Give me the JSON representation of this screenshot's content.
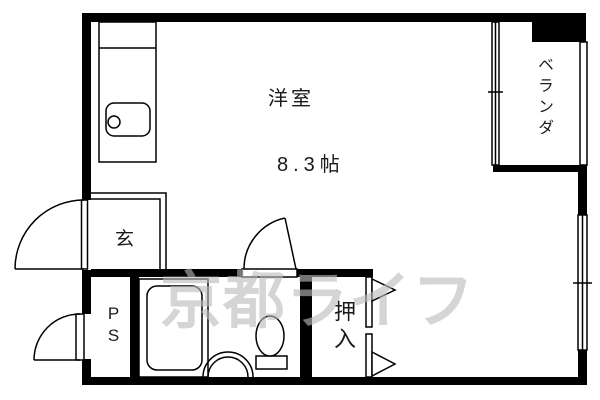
{
  "plan": {
    "labels": {
      "main_room": "洋室",
      "main_room_size": "8.3帖",
      "entrance": "玄",
      "veranda": "ベランダ",
      "pipe_space": "PS",
      "closet": "押入"
    },
    "watermark": "京都ライフ",
    "colors": {
      "wall": "#000000",
      "background": "#ffffff",
      "line": "#000000",
      "watermark_gray": "#bcbcbc"
    }
  }
}
